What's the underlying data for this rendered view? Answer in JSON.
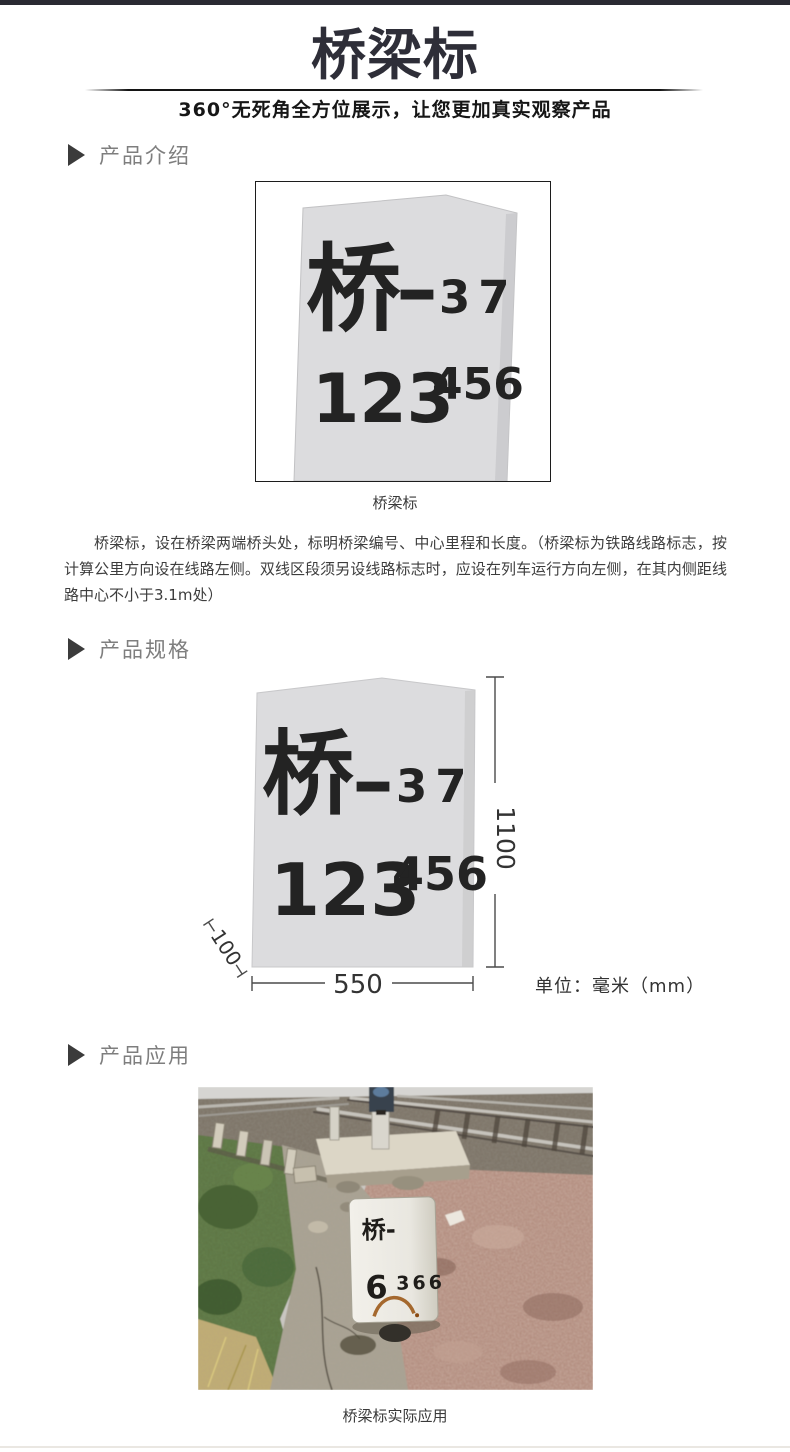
{
  "header": {
    "title": "桥梁标",
    "subtitle": "360°无死角全方位展示，让您更加真实观察产品"
  },
  "sections": {
    "intro_label": "产品介绍",
    "spec_label": "产品规格",
    "app_label": "产品应用"
  },
  "marker_sign": {
    "main_char": "桥",
    "dash": "—",
    "serial_top": "37",
    "mileage_main": "123",
    "mileage_sup": "456"
  },
  "intro": {
    "caption": "桥梁标",
    "description": "桥梁标，设在桥梁两端桥头处，标明桥梁编号、中心里程和长度。（桥梁标为铁路线路标志，按计算公里方向设在线路左侧。双线区段须另设线路标志时，应设在列车运行方向左侧，在其内侧距线路中心不小于3.1m处）"
  },
  "spec": {
    "dim_height": "1100",
    "dim_top": "100",
    "dim_width": "550",
    "unit": "单位：毫米（mm）"
  },
  "app": {
    "stone_line1": "桥-",
    "stone_digit": "6",
    "stone_number": "366",
    "caption": "桥梁标实际应用"
  },
  "colors": {
    "accent_dark": "#2a2a32",
    "marker_fill": "#dcdcde",
    "section_label_gray": "#7e7e7e"
  }
}
